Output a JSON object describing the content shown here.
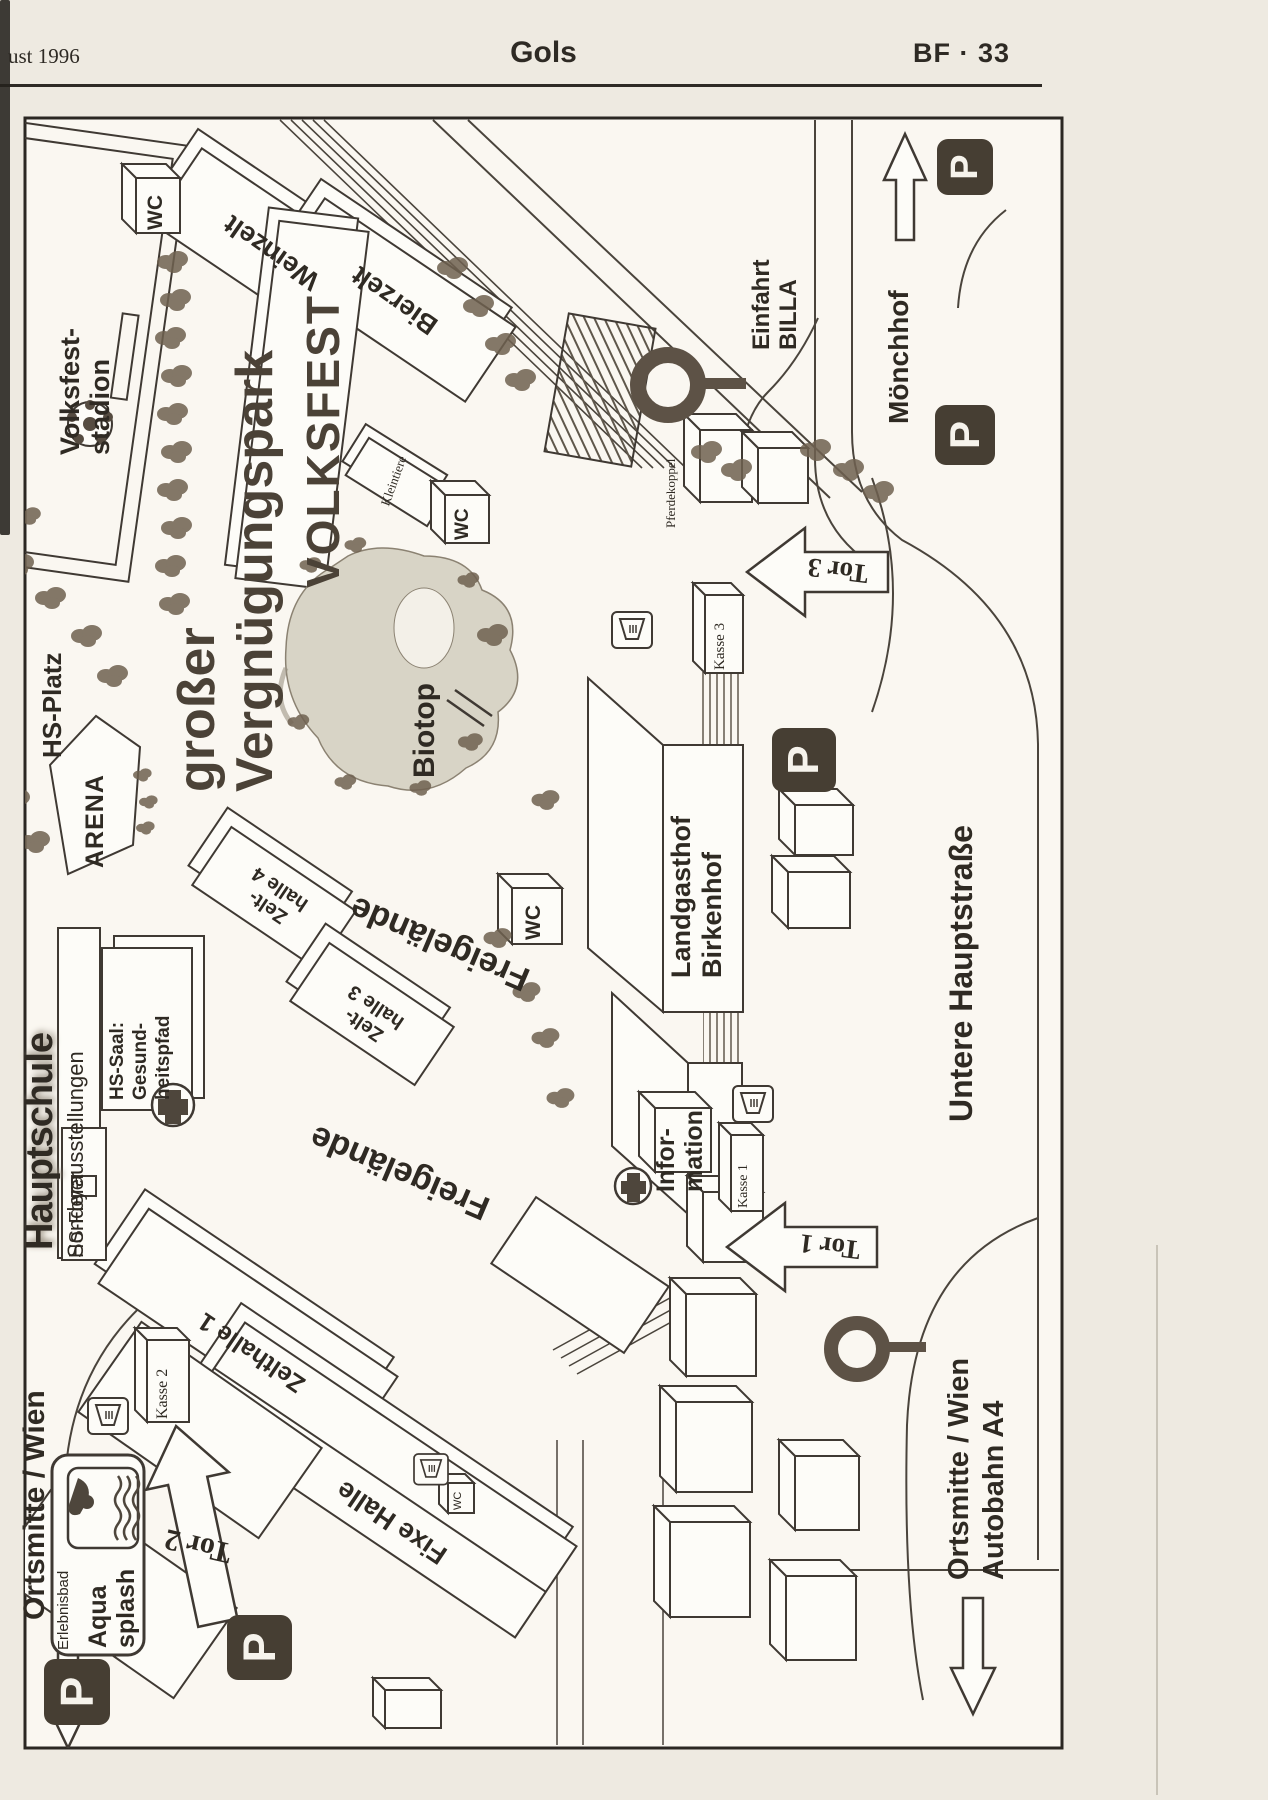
{
  "page": {
    "date_fragment": "ust 1996",
    "title": "Gols",
    "page_ref": "BF · 33"
  },
  "map": {
    "parking_label": "P",
    "areas": {
      "stadium": "Volksfest-\nstadion",
      "hs_platz": "HS-Platz",
      "arena": "ARENA",
      "park": "großer\nVergnügungspark",
      "volksfest": "VOLKSFEST",
      "weinzelt": "Weinzelt",
      "bierzelt": "Bierzelt",
      "kleintiere": "Kleintiere",
      "pferdekoppel": "Pferdekoppel",
      "biotop": "Biotop",
      "freigelaende": "Freigelände",
      "zelthalle4": "Zelt-\nhalle 4",
      "zelthalle3": "Zelt-\nhalle 3",
      "zelthalle1": "Zelthalle 1",
      "fixe_halle": "Fixe Halle",
      "hauptschule": "Hauptschule",
      "sonderausstellungen": "Sonderausstellungen",
      "hs_saal": "HS-Saal:\nGesund-\nheitspfad",
      "hs_foyer": "HS-Foyer",
      "landgasthof": "Landgasthof\nBirkenhof",
      "information": "Infor-\nmation",
      "erlebnisbad": "Erlebnisbad",
      "aqua_splash": "Aqua\nsplash",
      "wc": "WC"
    },
    "gates": {
      "tor1": "Tor 1",
      "tor2": "Tor 2",
      "tor3": "Tor 3"
    },
    "kassen": {
      "kasse1": "Kasse 1",
      "kasse2": "Kasse 2",
      "kasse3": "Kasse 3"
    },
    "directions": {
      "moenchhof": "Mönchhof",
      "einfahrt_billa": "Einfahrt\nBILLA",
      "ortsmitte_wien": "Ortsmitte / Wien",
      "ortsmitte_autobahn": "Ortsmitte / Wien\nAutobahn A4",
      "untere_hauptstrasse": "Untere Hauptstraße"
    }
  }
}
